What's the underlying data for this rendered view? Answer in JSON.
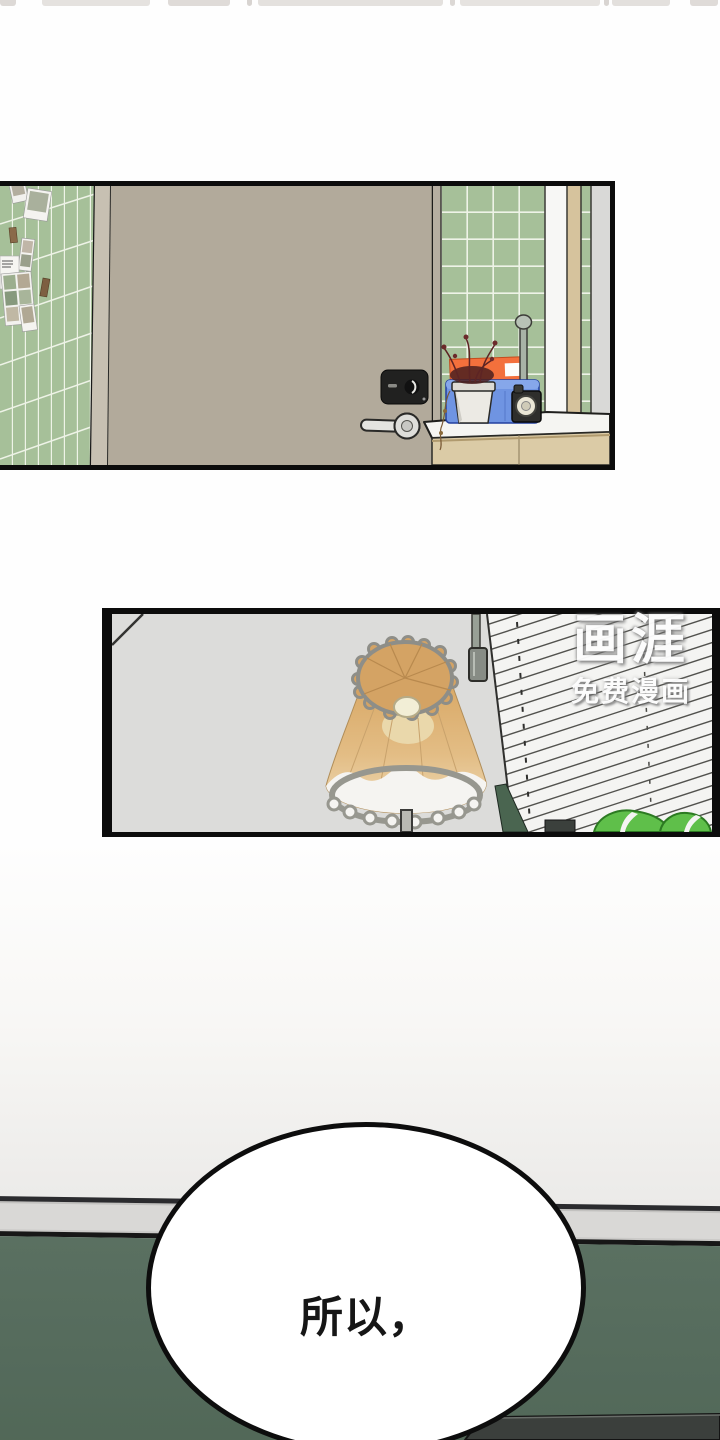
{
  "artwork": {
    "speech_bubble": {
      "text": "所以，"
    },
    "watermark": {
      "logo": "画涯",
      "tagline": "免费漫画"
    },
    "palette": {
      "ink_black": "#0c0c0c",
      "tile_green": "#a6c099",
      "door_beige": "#b2aa9b",
      "panel_wall_gray": "#dcdcda",
      "lamp_shade_tan": "#d4a364",
      "orange_box": "#f3703c",
      "crate_blue": "#6f94e2",
      "blinds_white": "#f4f4f2",
      "leaf_green": "#5fbf4a",
      "lower_wall_green": "#546a5b",
      "molding_gray": "#d9d8d6",
      "couch_dark": "#3b3f3c"
    }
  }
}
